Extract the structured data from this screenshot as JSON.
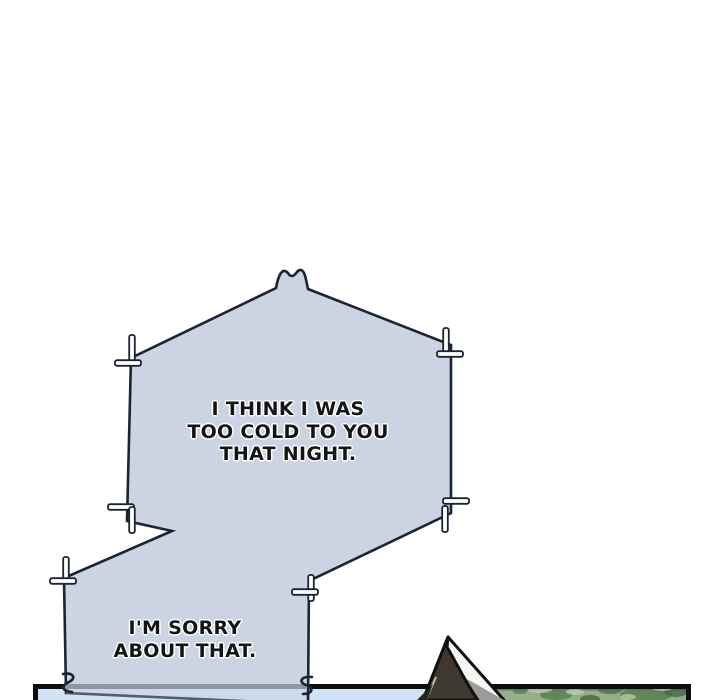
{
  "comic": {
    "bubbles": [
      {
        "text": "I THINK I WAS\nTOO COLD TO YOU\nTHAT NIGHT."
      },
      {
        "text": "I'M SORRY\nABOUT THAT."
      }
    ],
    "colors": {
      "background": "#ffffff",
      "bubble_fill": "#ccd4e4",
      "bubble_outline": "#1c2433",
      "stitch_fill": "#ffffff",
      "text": "#141414",
      "panel_border": "#0d0d0d",
      "sky": "#cfe3f4",
      "foliage": "#94ae8c",
      "foliage_dark": "#56754f",
      "foliage_light": "#c3d6b4",
      "tent_dark": "#3f3831",
      "tent_highlight": "#f6f6f4",
      "tent_gray": "#9c9c9a"
    }
  }
}
